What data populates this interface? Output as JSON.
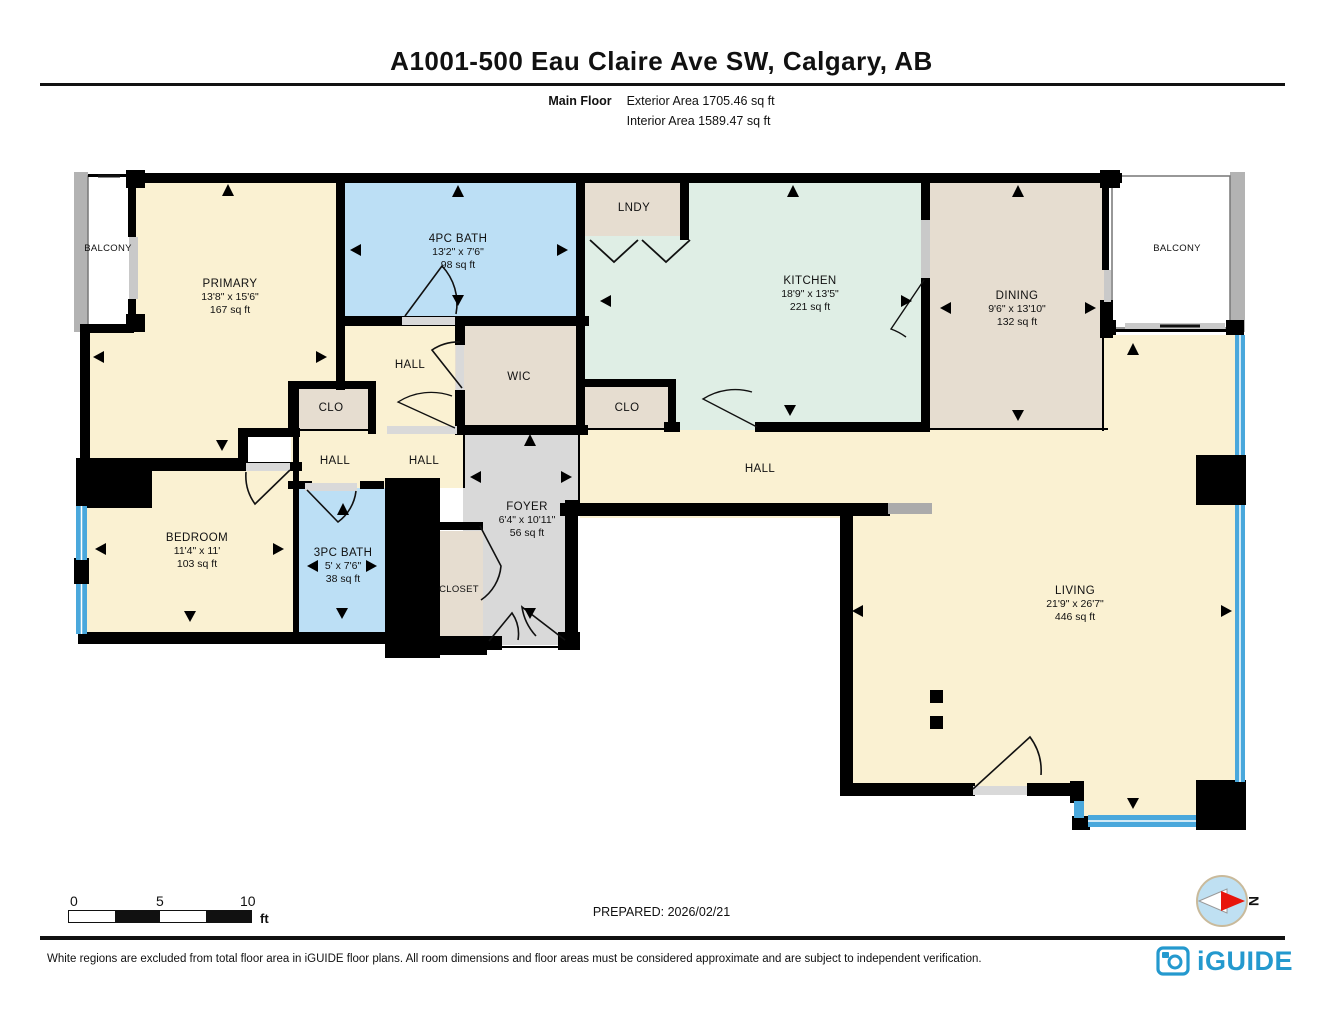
{
  "header": {
    "title": "A1001-500 Eau Claire Ave SW, Calgary, AB",
    "floor_label": "Main Floor",
    "exterior_area": "Exterior Area 1705.46 sq ft",
    "interior_area": "Interior Area 1589.47 sq ft"
  },
  "rooms": {
    "balcony_left": {
      "name": "BALCONY"
    },
    "balcony_right": {
      "name": "BALCONY"
    },
    "primary": {
      "name": "PRIMARY",
      "dims": "13'8\" x 15'6\"",
      "area": "167 sq ft"
    },
    "bath4": {
      "name": "4PC BATH",
      "dims": "13'2\" x 7'6\"",
      "area": "98 sq ft"
    },
    "lndy": {
      "name": "LNDY"
    },
    "kitchen": {
      "name": "KITCHEN",
      "dims": "18'9\" x 13'5\"",
      "area": "221 sq ft"
    },
    "dining": {
      "name": "DINING",
      "dims": "9'6\" x 13'10\"",
      "area": "132 sq ft"
    },
    "hall_upper": {
      "name": "HALL"
    },
    "wic": {
      "name": "WIC"
    },
    "clo_left": {
      "name": "CLO"
    },
    "clo_mid": {
      "name": "CLO"
    },
    "hall_left": {
      "name": "HALL"
    },
    "hall_mid": {
      "name": "HALL"
    },
    "hall_long": {
      "name": "HALL"
    },
    "foyer": {
      "name": "FOYER",
      "dims": "6'4\" x 10'11\"",
      "area": "56 sq ft"
    },
    "bedroom": {
      "name": "BEDROOM",
      "dims": "11'4\" x 11'",
      "area": "103 sq ft"
    },
    "bath3": {
      "name": "3PC BATH",
      "dims": "5' x 7'6\"",
      "area": "38 sq ft"
    },
    "closet": {
      "name": "CLOSET"
    },
    "living": {
      "name": "LIVING",
      "dims": "21'9\" x 26'7\"",
      "area": "446 sq ft"
    }
  },
  "scale_bar": {
    "tick0": "0",
    "tick5": "5",
    "tick10": "10",
    "unit": "ft"
  },
  "prepared": "PREPARED: 2026/02/21",
  "compass": {
    "north_label": "N"
  },
  "footer": {
    "disclaimer": "White regions are excluded from total floor area in iGUIDE floor plans. All room dimensions and floor areas must be considered approximate and are subject to independent verification.",
    "brand": "iGUIDE"
  },
  "colors": {
    "room_cream": "#FAF1D2",
    "room_blue": "#BCDFF5",
    "room_green": "#DFEEE5",
    "room_tan": "#E6DDD0",
    "room_gray": "#D9D9D9",
    "wall": "#000000",
    "window_blue": "#4AA8DC",
    "rail_gray": "#B3B3B3",
    "brand_blue": "#2499CE",
    "compass_red": "#E8150B",
    "compass_blue": "#BFE0F2"
  }
}
